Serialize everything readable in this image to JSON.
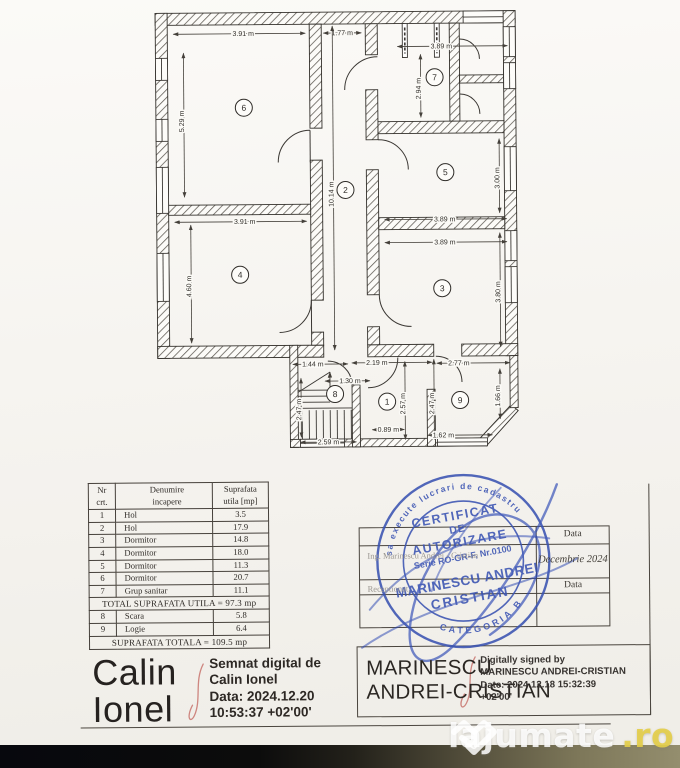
{
  "plan": {
    "room_numbers": [
      {
        "n": "6",
        "x": 246,
        "y": 107
      },
      {
        "n": "2",
        "x": 347,
        "y": 190
      },
      {
        "n": "7",
        "x": 437,
        "y": 78
      },
      {
        "n": "5",
        "x": 447,
        "y": 173
      },
      {
        "n": "4",
        "x": 241,
        "y": 274
      },
      {
        "n": "3",
        "x": 443,
        "y": 289
      },
      {
        "n": "8",
        "x": 335,
        "y": 394
      },
      {
        "n": "1",
        "x": 387,
        "y": 402
      },
      {
        "n": "9",
        "x": 460,
        "y": 401
      }
    ],
    "dimensions": [
      {
        "t": "3.91 m",
        "x": 246,
        "y": 33,
        "r": 0,
        "l": [
          176,
          33,
          308,
          33
        ]
      },
      {
        "t": "1.77 m",
        "x": 345,
        "y": 33,
        "r": 0,
        "l": [
          326,
          33,
          364,
          33
        ]
      },
      {
        "t": "3.89 m",
        "x": 444,
        "y": 47,
        "r": 0,
        "l": [
          400,
          47,
          510,
          47
        ]
      },
      {
        "t": "5.29 m",
        "x": 186,
        "y": 118,
        "r": -90,
        "l": [
          186,
          52,
          186,
          196
        ]
      },
      {
        "t": "2.94 m",
        "x": 423,
        "y": 87,
        "r": -90,
        "l": [
          423,
          55,
          423,
          118
        ]
      },
      {
        "t": "10.14 m",
        "x": 335,
        "y": 192,
        "r": -90,
        "l": [
          335,
          26,
          335,
          350
        ]
      },
      {
        "t": "3.00 m",
        "x": 501,
        "y": 177,
        "r": -90,
        "l": [
          501,
          140,
          501,
          214
        ]
      },
      {
        "t": "3.89 m",
        "x": 446,
        "y": 220,
        "r": 0,
        "l": [
          386,
          220,
          508,
          220
        ]
      },
      {
        "t": "3.89 m",
        "x": 446,
        "y": 243,
        "r": 0,
        "l": [
          386,
          243,
          508,
          243
        ]
      },
      {
        "t": "3.91 m",
        "x": 246,
        "y": 221,
        "r": 0,
        "l": [
          176,
          221,
          308,
          221
        ]
      },
      {
        "t": "4.60 m",
        "x": 192,
        "y": 283,
        "r": -90,
        "l": [
          192,
          224,
          192,
          342
        ]
      },
      {
        "t": "3.80 m",
        "x": 501,
        "y": 291,
        "r": -90,
        "l": [
          501,
          234,
          501,
          348
        ]
      },
      {
        "t": "1.44 m",
        "x": 313,
        "y": 364,
        "r": 0,
        "l": [
          293,
          364,
          348,
          364
        ]
      },
      {
        "t": "2.19 m",
        "x": 377,
        "y": 363,
        "r": 0,
        "l": [
          352,
          363,
          432,
          363
        ]
      },
      {
        "t": "2.77 m",
        "x": 459,
        "y": 364,
        "r": 0,
        "l": [
          437,
          364,
          510,
          364
        ]
      },
      {
        "t": "1.30 m",
        "x": 350,
        "y": 381,
        "r": 0,
        "l": [
          325,
          381,
          370,
          381
        ]
      },
      {
        "t": "2.47 m",
        "x": 301,
        "y": 407,
        "r": -90,
        "l": [
          301,
          378,
          301,
          437
        ]
      },
      {
        "t": "2.57 m",
        "x": 405,
        "y": 402,
        "r": -90,
        "l": [
          405,
          362,
          405,
          440
        ]
      },
      {
        "t": "2.47 m",
        "x": 434,
        "y": 402,
        "r": -90,
        "l": [
          434,
          360,
          434,
          440
        ]
      },
      {
        "t": "1.66 m",
        "x": 500,
        "y": 395,
        "r": -90,
        "l": [
          500,
          370,
          500,
          420
        ]
      },
      {
        "t": "0.89 m",
        "x": 388,
        "y": 430,
        "r": 0,
        "l": [
          372,
          430,
          404,
          430
        ]
      },
      {
        "t": "2.59 m",
        "x": 328,
        "y": 442,
        "r": 0,
        "l": [
          300,
          442,
          356,
          442
        ]
      },
      {
        "t": "1.62 m",
        "x": 443,
        "y": 436,
        "r": 0,
        "l": [
          428,
          436,
          492,
          436
        ]
      }
    ]
  },
  "table": {
    "headers": {
      "col1": "Nr\ncrt.",
      "col2": "Denumire\nincapere",
      "col3": "Suprafata\nutila [mp]"
    },
    "rows": [
      {
        "nr": "1",
        "name": "Hol",
        "area": "3.5"
      },
      {
        "nr": "2",
        "name": "Hol",
        "area": "17.9"
      },
      {
        "nr": "3",
        "name": "Dormitor",
        "area": "14.8"
      },
      {
        "nr": "4",
        "name": "Dormitor",
        "area": "18.0"
      },
      {
        "nr": "5",
        "name": "Dormitor",
        "area": "11.3"
      },
      {
        "nr": "6",
        "name": "Dormitor",
        "area": "20.7"
      },
      {
        "nr": "7",
        "name": "Grup sanitar",
        "area": "11.1"
      }
    ],
    "total_utila": "TOTAL SUPRAFATA UTILA = 97.3 mp",
    "rows2": [
      {
        "nr": "8",
        "name": "Scara",
        "area": "5.8"
      },
      {
        "nr": "9",
        "name": "Logie",
        "area": "6.4"
      }
    ],
    "total": "SUPRAFATA TOTALA = 109.5 mp"
  },
  "stamp": {
    "ring_top": "sa execute lucrari de cadastru",
    "ring_bottom": "CATEGORIA B",
    "line1": "CERTIFICAT",
    "line2": "DE",
    "line3": "AUTORIZARE",
    "line4": "Serie RO-GR-F, Nr.0100",
    "line5": "MARINESCU ANDREI",
    "line6": "CRISTIAN",
    "color": "#3a53b2"
  },
  "approval_box": {
    "faint_line1": "Ing. Marinescu Andrei - Cristian",
    "faint_line2": "Receptionat,",
    "row1_label": "Data",
    "row2_value": "Decembrie 2024",
    "row3_label": "Data"
  },
  "signatures": {
    "left_name_line1": "Calin",
    "left_name_line2": "Ionel",
    "left_sig_lines": [
      "Semnat digital de",
      "Calin Ionel",
      "Data: 2024.12.20",
      "10:53:37 +02'00'"
    ],
    "right_name_line1": "MARINESCU",
    "right_name_line2": "ANDREI-CRISTIAN",
    "right_sig_lines": [
      "Digitally signed by",
      "MARINESCU ANDREI-CRISTIAN",
      "Date: 2024.12.18 15:32:39",
      "+02'00'"
    ]
  },
  "watermark": {
    "text": "lajumate",
    "tld": ".ro"
  }
}
